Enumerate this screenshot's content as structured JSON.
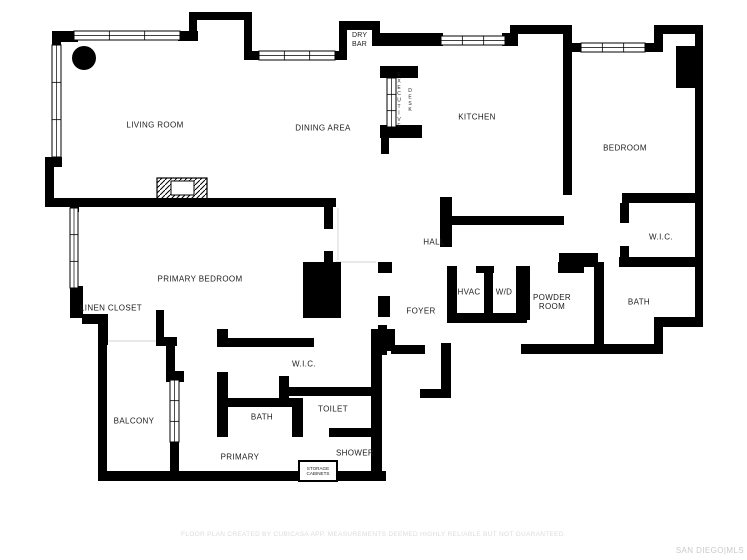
{
  "canvas": {
    "width": 747,
    "height": 560,
    "background": "#ffffff"
  },
  "colors": {
    "wall": "#000000",
    "room_label": "#1c1c1c",
    "open_boundary": "#dcdcdc",
    "disclaimer": "#dcdcdc",
    "watermark": "#c9c9c9"
  },
  "rooms": {
    "living_room": {
      "label": "LIVING ROOM"
    },
    "dining_area": {
      "label": "DINING AREA"
    },
    "dry_bar": {
      "label": "DRY BAR"
    },
    "executive_desk": {
      "line1": "EXECUTIVE",
      "line2": "DESK"
    },
    "kitchen": {
      "label": "KITCHEN"
    },
    "bedroom": {
      "label": "BEDROOM"
    },
    "bedroom_wic": {
      "label": "W.I.C."
    },
    "bedroom_bath": {
      "label": "BATH"
    },
    "hall": {
      "label": "HALL"
    },
    "foyer": {
      "label": "FOYER"
    },
    "hvac": {
      "label": "HVAC"
    },
    "washer_dryer": {
      "label": "W/D"
    },
    "powder_room": {
      "label": "POWDER ROOM"
    },
    "primary_bedroom": {
      "label": "PRIMARY BEDROOM"
    },
    "linen_closet": {
      "label": "LINEN CLOSET"
    },
    "balcony": {
      "label": "BALCONY"
    },
    "primary_wic": {
      "label": "W.I.C."
    },
    "primary_bath": {
      "label": "BATH"
    },
    "toilet": {
      "label": "TOILET"
    },
    "primary": {
      "label": "PRIMARY"
    },
    "shower": {
      "label": "SHOWER"
    },
    "storage_cabinets": {
      "label": "STORAGE CABINETS"
    }
  },
  "footer": {
    "disclaimer": "FLOOR PLAN CREATED BY CUBICASA APP. MEASUREMENTS DEEMED HIGHLY RELIABLE BUT NOT GUARANTEED.",
    "watermark": "SAN DIEGO|MLS"
  }
}
